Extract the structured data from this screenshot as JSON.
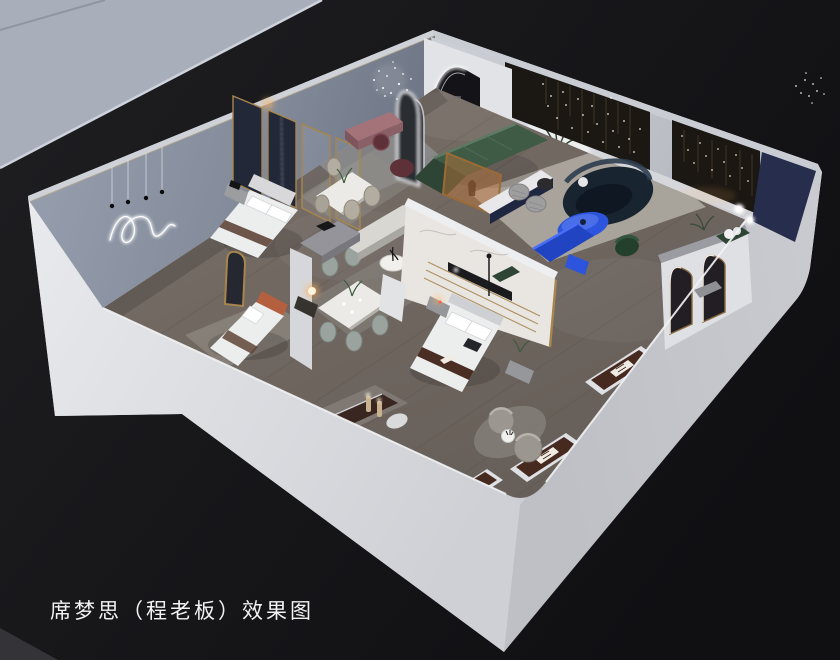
{
  "caption": {
    "text": "席梦思（程老板）效果图"
  },
  "palette": {
    "bg_left": "#1e1e21",
    "bg_right": "#111114",
    "slab": "#a9aebb",
    "slab_edge": "#ced2dc",
    "shell": "#cdced3",
    "shell_bright": "#e7e8eb",
    "shell_mid": "#c6c7cc",
    "shell_dark": "#b2b3b9",
    "wall_top": "#ced1d7",
    "cut_lip": "#b5a88c",
    "wall_blue": "#8d95a5",
    "wall_blue_dark": "#6e7584",
    "floor": "#6f6660",
    "plank": "#57504a",
    "rug": "#a8a49c",
    "rug_cool": "#9aa0a8",
    "dark_wall": "#1b1713",
    "navy_panel": "#272e4d",
    "navy_curtain": "#232838",
    "gold": "#a6854e",
    "bed_white": "#eceded",
    "headboard": "#34373e",
    "runner": "#5f4436",
    "rust": "#b45f3e",
    "mattress": "#46291f",
    "mattress_base": "#dfe0e3",
    "label": "#f0ece4",
    "green_sofa": "#3f5a45",
    "green_dark": "#2e4535",
    "navy_sofa": "#182430",
    "accent_blue": "#2d54dd",
    "accent_blue_dark": "#2145c2",
    "marble": "#e9e6e2",
    "mauve": "#9a6a70",
    "maroon": "#5e3038",
    "glow_warm": "#ffb45e",
    "white": "#ffffff",
    "text": "#f2f2f2"
  },
  "scene": {
    "type": "3d-interior-cutaway-rendering",
    "items": [
      {
        "id": "neighbor-wall-slab",
        "color_key": "slab"
      },
      {
        "id": "exterior-cutaway-walls",
        "color_key": "shell"
      },
      {
        "id": "showroom-floor",
        "color_key": "floor"
      },
      {
        "id": "feature-wall-neon-squiggle",
        "color_key": "wall_blue"
      },
      {
        "id": "pendant-bulb-lights",
        "color_key": "white"
      },
      {
        "id": "navy-curtain-panels",
        "color_key": "navy_curtain"
      },
      {
        "id": "glass-partitions-gold-frame",
        "color_key": "gold"
      },
      {
        "id": "bedroom-left-bed",
        "color_key": "bed_white"
      },
      {
        "id": "bedroom-lower-left-bed",
        "color_key": "rust"
      },
      {
        "id": "bedroom-middle-bed",
        "color_key": "bed_white"
      },
      {
        "id": "marble-feature-wall",
        "color_key": "marble"
      },
      {
        "id": "lounge-mauve-bench",
        "color_key": "mauve"
      },
      {
        "id": "chandelier-sparkle",
        "color_key": "white"
      },
      {
        "id": "oval-floor-mirrors",
        "color_key": "white"
      },
      {
        "id": "led-arched-portal",
        "color_key": "white"
      },
      {
        "id": "backlit-panel-palm",
        "color_key": "white"
      },
      {
        "id": "dark-display-walls-string-lights",
        "color_key": "dark_wall"
      },
      {
        "id": "navy-corner-panel",
        "color_key": "navy_panel"
      },
      {
        "id": "green-sectional-sofa",
        "color_key": "green_sofa"
      },
      {
        "id": "navy-curved-sofa",
        "color_key": "navy_sofa"
      },
      {
        "id": "blue-oval-coffee-table",
        "color_key": "accent_blue"
      },
      {
        "id": "blue-media-bench",
        "color_key": "accent_blue_dark"
      },
      {
        "id": "dining-set-upper",
        "color_key": "marble"
      },
      {
        "id": "dining-set-lower",
        "color_key": "marble"
      },
      {
        "id": "arched-mirror-wall",
        "color_key": "shell_bright"
      },
      {
        "id": "green-armchair",
        "color_key": "green_dark"
      },
      {
        "id": "display-mattress-1",
        "color_key": "mattress"
      },
      {
        "id": "display-mattress-2",
        "color_key": "mattress"
      },
      {
        "id": "display-mattress-3",
        "color_key": "mattress"
      },
      {
        "id": "display-mattress-4",
        "color_key": "mattress"
      },
      {
        "id": "barrel-armchairs",
        "color_key": "rug"
      },
      {
        "id": "globe-floor-lamps",
        "color_key": "white"
      }
    ]
  }
}
